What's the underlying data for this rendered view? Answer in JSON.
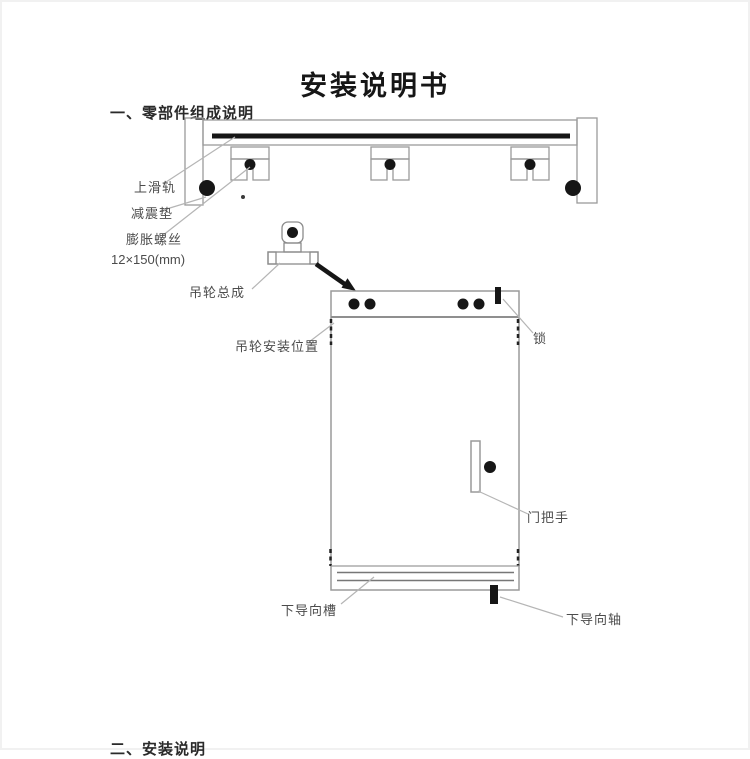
{
  "page": {
    "title": "安装说明书",
    "section1_heading": "一、零部件组成说明",
    "section2_heading": "二、安装说明"
  },
  "labels": {
    "top_rail": "上滑轨",
    "shock_pad": "减震垫",
    "expansion_screw": "膨胀螺丝",
    "screw_size": "12×150(mm)",
    "hanger_assembly": "吊轮总成",
    "hanger_position": "吊轮安装位置",
    "lock": "锁",
    "door_handle": "门把手",
    "bottom_guide_groove": "下导向槽",
    "bottom_guide_shaft": "下导向轴"
  },
  "colors": {
    "ink": "#161616",
    "outline": "#9a9a9a",
    "leader": "#b5b5b5",
    "label_text": "#4c4c4c"
  }
}
